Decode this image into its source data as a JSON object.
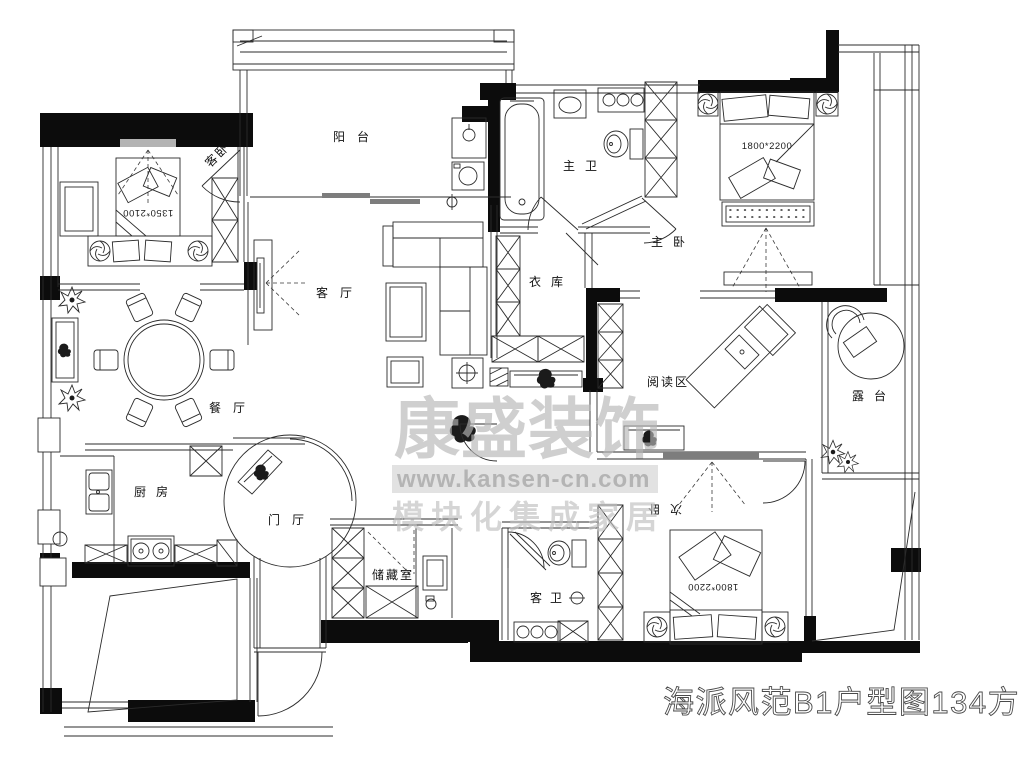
{
  "plan": {
    "title": "海派风范B1户型图134方",
    "watermark": {
      "brand": "康盛装饰",
      "url": "www.kansen-cn.com",
      "tagline": "模块化集成家居"
    },
    "rooms": {
      "guest_bedroom": {
        "label": "客卧",
        "bed_size": "1350*2100"
      },
      "balcony": {
        "label": "阳台"
      },
      "master_bath": {
        "label": "主卫"
      },
      "master_bedroom": {
        "label": "主卧",
        "bed_size": "1800*2200"
      },
      "closet": {
        "label": "衣库"
      },
      "living_room": {
        "label": "客厅"
      },
      "dining_room": {
        "label": "餐厅"
      },
      "kitchen": {
        "label": "厨房"
      },
      "entry_hall": {
        "label": "门厅"
      },
      "storage_room": {
        "label": "储藏室"
      },
      "guest_bath": {
        "label": "客卫"
      },
      "second_bedroom": {
        "label": "次卧",
        "bed_size": "1800*2200"
      },
      "reading_area": {
        "label": "阅读区"
      },
      "terrace": {
        "label": "露台"
      }
    },
    "colors": {
      "wall": "#0c0c0c",
      "line": "#2b2b2b",
      "watermark_gray": "#b6b6b6",
      "background": "#ffffff"
    }
  }
}
